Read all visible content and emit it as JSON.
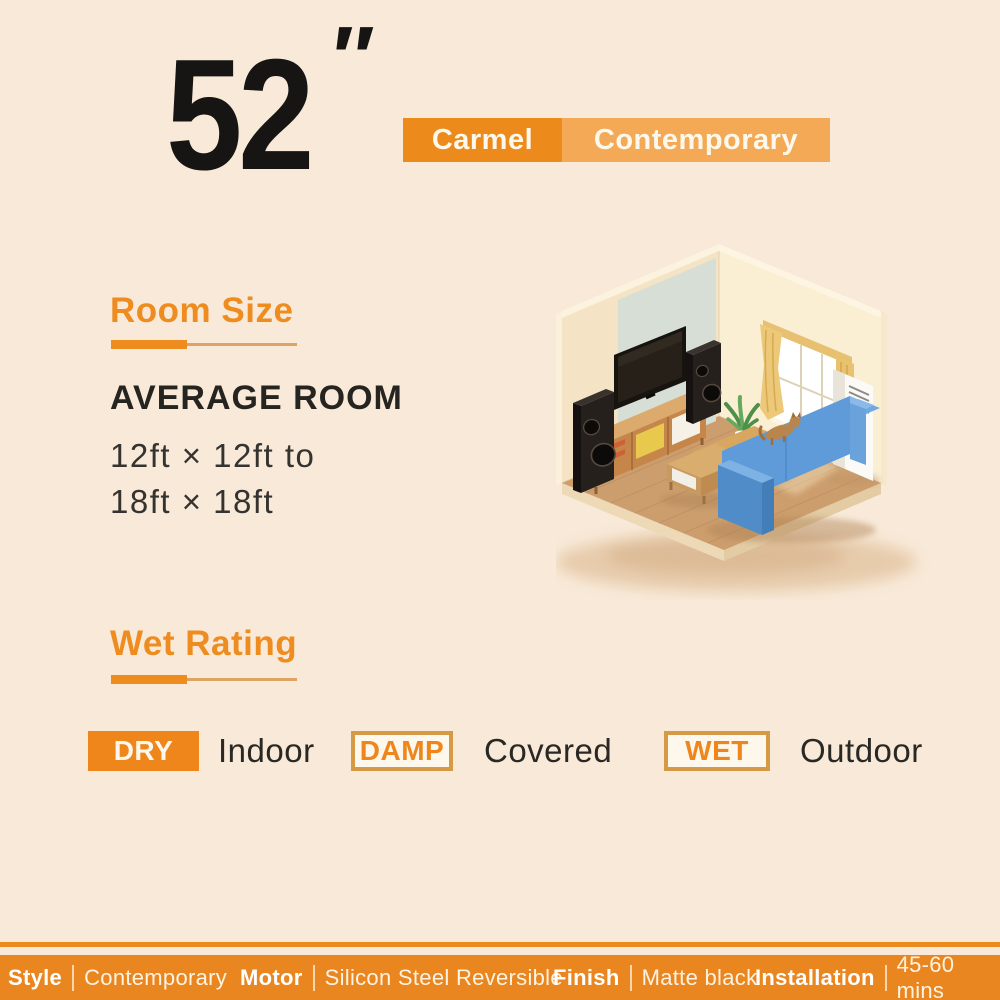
{
  "colors": {
    "background": "#f8e9d8",
    "accent_orange": "#ee861c",
    "heading_orange": "#ee8c1f",
    "model_name_bg": "#ec8a1c",
    "model_style_bg": "#f3a955",
    "badge_border": "#d59a45",
    "bottom_bar": "#ea861f",
    "text_dark": "#262420",
    "text_white": "#fdf3e2"
  },
  "header": {
    "size_value": "52",
    "size_unit_mark": "″",
    "model_name": "Carmel",
    "model_style": "Contemporary"
  },
  "room_size": {
    "heading": "Room Size",
    "subheading": "AVERAGE ROOM",
    "range_line1": "12ft × 12ft to",
    "range_line2": "18ft × 18ft"
  },
  "wet_rating": {
    "heading": "Wet Rating",
    "ratings": [
      {
        "badge": "DRY",
        "badge_style": "filled",
        "label": "Indoor"
      },
      {
        "badge": "DAMP",
        "badge_style": "outline",
        "label": "Covered"
      },
      {
        "badge": "WET",
        "badge_style": "outline",
        "label": "Outdoor"
      }
    ]
  },
  "specs_bar": {
    "items": [
      {
        "label": "Style",
        "value": "Contemporary"
      },
      {
        "label": "Motor",
        "value": "Silicon Steel Reversible"
      },
      {
        "label": "Finish",
        "value": "Matte black"
      },
      {
        "label": "Installation",
        "value": "45-60 mins"
      }
    ]
  },
  "illustration": {
    "name": "isometric-living-room",
    "items": [
      "wall-tv",
      "media-console",
      "floor-speakers",
      "window-with-curtains",
      "blue-sofa",
      "coffee-tables",
      "potted-plant",
      "cat",
      "floor-ac-unit",
      "wood-floor"
    ]
  }
}
